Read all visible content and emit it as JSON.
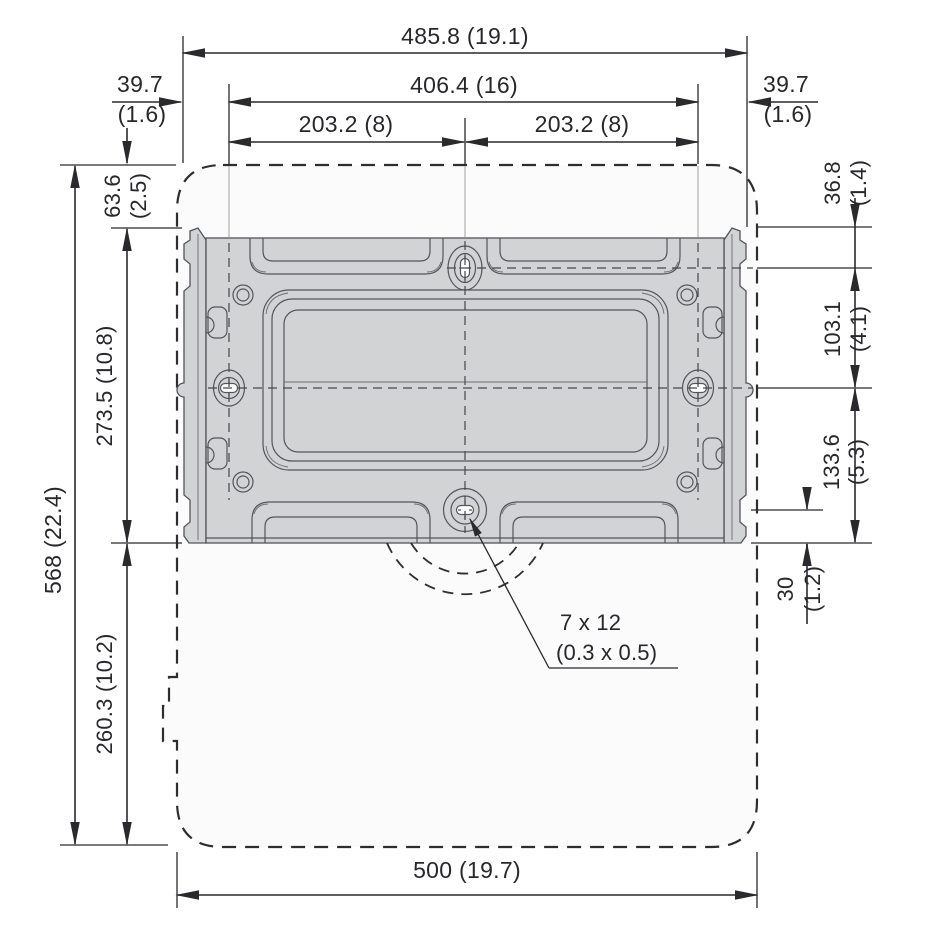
{
  "dimensions": {
    "overall_width": "485.8 (19.1)",
    "mount_hole_span": "406.4 (16)",
    "half_span_left": "203.2 (8)",
    "half_span_right": "203.2 (8)",
    "edge_offset_left": {
      "mm": "39.7",
      "in": "(1.6)"
    },
    "edge_offset_right": {
      "mm": "39.7",
      "in": "(1.6)"
    },
    "top_to_bracket": {
      "mm": "63.6",
      "in": "(2.5)"
    },
    "bracket_height": "273.5 (10.8)",
    "overall_height": "568 (22.4)",
    "bracket_to_bottom": "260.3 (10.2)",
    "bracket_top_to_slot": {
      "mm": "36.8",
      "in": "(1.4)"
    },
    "slot_to_keyhole": {
      "mm": "103.1",
      "in": "(4.1)"
    },
    "keyhole_to_bracket_bottom": {
      "mm": "133.6",
      "in": "(5.3)"
    },
    "slot_to_bracket_bottom": {
      "mm": "30",
      "in": "(1.2)"
    },
    "overall_width_bottom": "500 (19.7)",
    "slot_callout": {
      "line1": "7 x 12",
      "line2": "(0.3 x 0.5)"
    }
  },
  "colors": {
    "bracket_fill": "#d2d3d5",
    "bracket_line": "#54555a",
    "dimension_line": "#2a2a2e"
  }
}
